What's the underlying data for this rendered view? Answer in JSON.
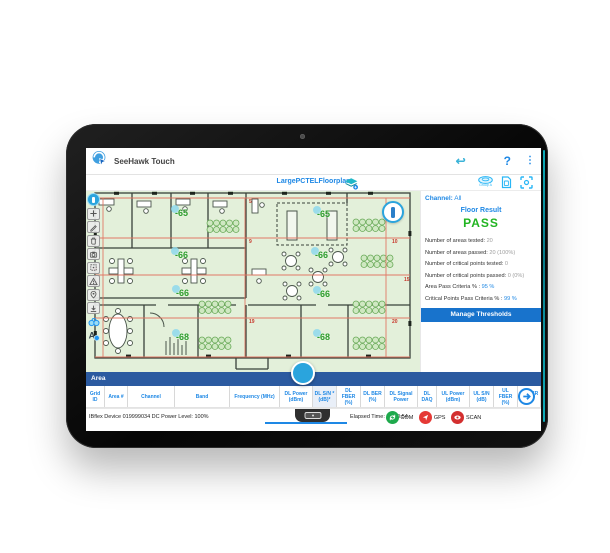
{
  "app_bar": {
    "title": "SeeHawk Touch",
    "help_label": "?"
  },
  "sub_header": {
    "floorplan_name": "LargePCTELFloorplan",
    "group_label": "Group A"
  },
  "toolbar": {
    "icons": [
      "info-icon",
      "add-icon",
      "edit-icon",
      "delete-icon",
      "camera-icon",
      "note-icon",
      "warning-icon",
      "location-icon",
      "download-icon",
      "binoculars-icon",
      "text-size-icon"
    ]
  },
  "floorplan": {
    "readings": [
      {
        "x": 89,
        "y": 17,
        "value": "-65"
      },
      {
        "x": 231,
        "y": 18,
        "value": "-65"
      },
      {
        "x": 89,
        "y": 59,
        "value": "-66"
      },
      {
        "x": 229,
        "y": 59,
        "value": "-66"
      },
      {
        "x": 90,
        "y": 97,
        "value": "-66"
      },
      {
        "x": 231,
        "y": 98,
        "value": "-66"
      },
      {
        "x": 90,
        "y": 141,
        "value": "-68"
      },
      {
        "x": 231,
        "y": 141,
        "value": "-68"
      }
    ],
    "grid_labels": [
      {
        "x": 163,
        "y": 8,
        "text": "5"
      },
      {
        "x": 163,
        "y": 48,
        "text": "9"
      },
      {
        "x": 306,
        "y": 48,
        "text": "10"
      },
      {
        "x": 318,
        "y": 86,
        "text": "15"
      },
      {
        "x": 6,
        "y": 76,
        "text": "16"
      },
      {
        "x": 163,
        "y": 128,
        "text": "19"
      },
      {
        "x": 306,
        "y": 128,
        "text": "20"
      }
    ]
  },
  "right_panel": {
    "channel_label": "Channel:",
    "channel_value": " All",
    "floor_result_title": "Floor Result",
    "result": "PASS",
    "stats": [
      {
        "label": "Number of areas tested: ",
        "value": "20",
        "cls": "gray"
      },
      {
        "label": "Number of areas passed: ",
        "value": "20 (100%)",
        "cls": "gray"
      },
      {
        "label": "Number of critical points tested: ",
        "value": "0",
        "cls": "gray"
      },
      {
        "label": "Number of critical points passed: ",
        "value": "0 (0%)",
        "cls": "gray"
      },
      {
        "label": "Area Pass Criteria % : ",
        "value": "95 %",
        "cls": "blue"
      },
      {
        "label": "Critical Points Pass Criteria % : ",
        "value": "99 %",
        "cls": "blue"
      }
    ],
    "manage_button": "Manage Thresholds"
  },
  "area_bar": {
    "label": "Area"
  },
  "table": {
    "columns": [
      {
        "text": "Grid ID",
        "w": 19
      },
      {
        "text": "Area #",
        "w": 23
      },
      {
        "text": "Channel",
        "w": 47
      },
      {
        "text": "Band",
        "w": 55
      },
      {
        "text": "Frequency (MHz)",
        "w": 50
      },
      {
        "text": "DL Power (dBm)",
        "w": 33
      },
      {
        "text": "DL S/N *(dB)*",
        "w": 24,
        "cls": "selected"
      },
      {
        "text": "DL FBER (%)",
        "w": 24
      },
      {
        "text": "DL BER (%)",
        "w": 24
      },
      {
        "text": "DL Signal Power",
        "w": 33
      },
      {
        "text": "DL DAQ",
        "w": 19
      },
      {
        "text": "UL Power (dBm)",
        "w": 33
      },
      {
        "text": "UL S/N (dB)",
        "w": 24
      },
      {
        "text": "UL FBER (%)",
        "w": 24
      },
      {
        "text": "UL BER (%)",
        "w": 23
      }
    ]
  },
  "status_bar": {
    "device_info": "IBflex Device 019999034  DC Power Level: 100%",
    "elapsed": "Elapsed Time: 00:00:54",
    "badges": [
      {
        "label": "COM"
      },
      {
        "label": "GPS"
      },
      {
        "label": "SCAN"
      }
    ]
  },
  "colors": {
    "accent_blue": "#1e88e5",
    "pass_green": "#21b421",
    "area_bar_blue": "#2b5aa0",
    "com_green": "#1ea94c",
    "gps_red": "#e53935",
    "scan_red": "#d32f2f",
    "floorplan_tint": "#e3f0da",
    "grid_red": "#e2735f"
  }
}
